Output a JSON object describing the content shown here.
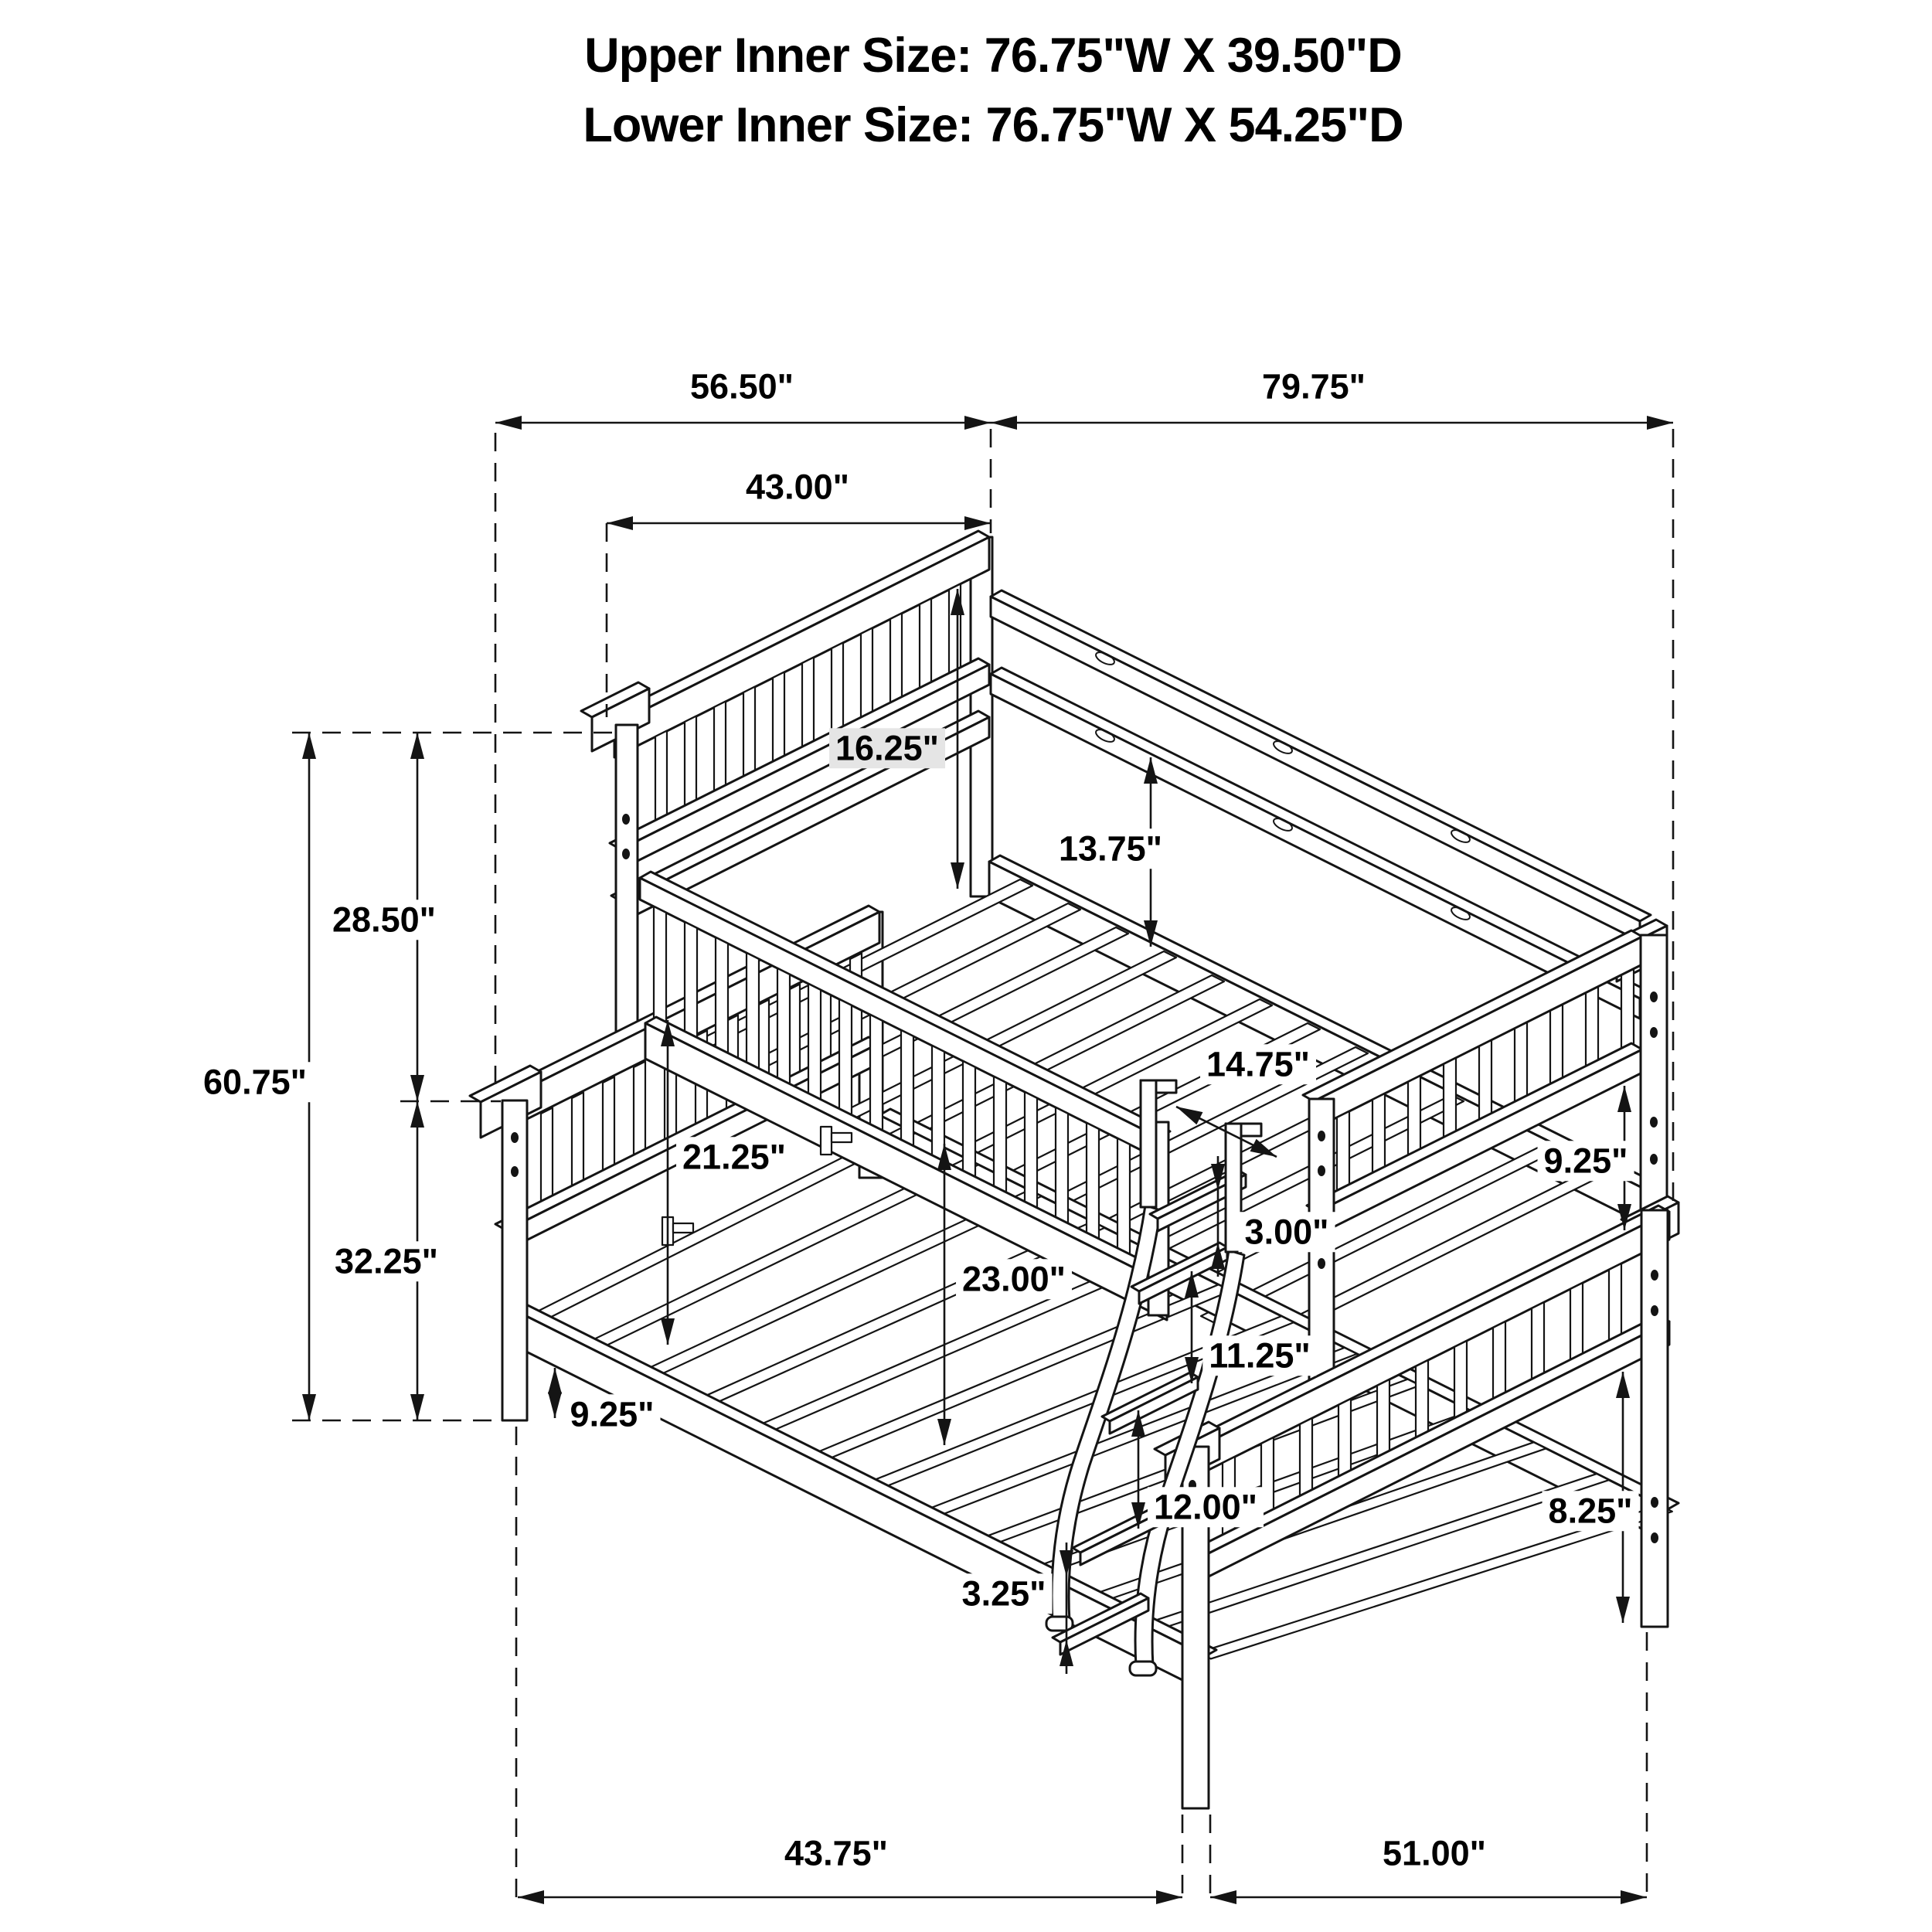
{
  "header": {
    "upper_inner_size": "Upper Inner Size: 76.75\"W X 39.50\"D",
    "lower_inner_size": "Lower Inner Size: 76.75\"W X 54.25\"D"
  },
  "dimensions": {
    "upper_overall_depth": "56.50\"",
    "overall_length": "79.75\"",
    "upper_headboard_depth": "43.00\"",
    "upper_headboard_height": "16.25\"",
    "upper_guardrail_height": "13.75\"",
    "bunk_gap_height": "28.50\"",
    "overall_height": "60.75\"",
    "lower_section_height": "32.25\"",
    "lower_headboard_clearance": "21.25\"",
    "under_bunk_clearance": "23.00\"",
    "ladder_opening_width": "14.75\"",
    "rail_to_step_gap": "3.00\"",
    "upper_rail_depth": "9.25\"",
    "ladder_step_spacing_upper": "11.25\"",
    "ladder_step_spacing_lower": "12.00\"",
    "lower_rail_depth": "8.25\"",
    "under_bed_clearance": "9.25\"",
    "bottom_step_gap": "3.25\"",
    "lower_depth_left_segment": "43.75\"",
    "lower_depth_right_segment": "51.00\""
  }
}
